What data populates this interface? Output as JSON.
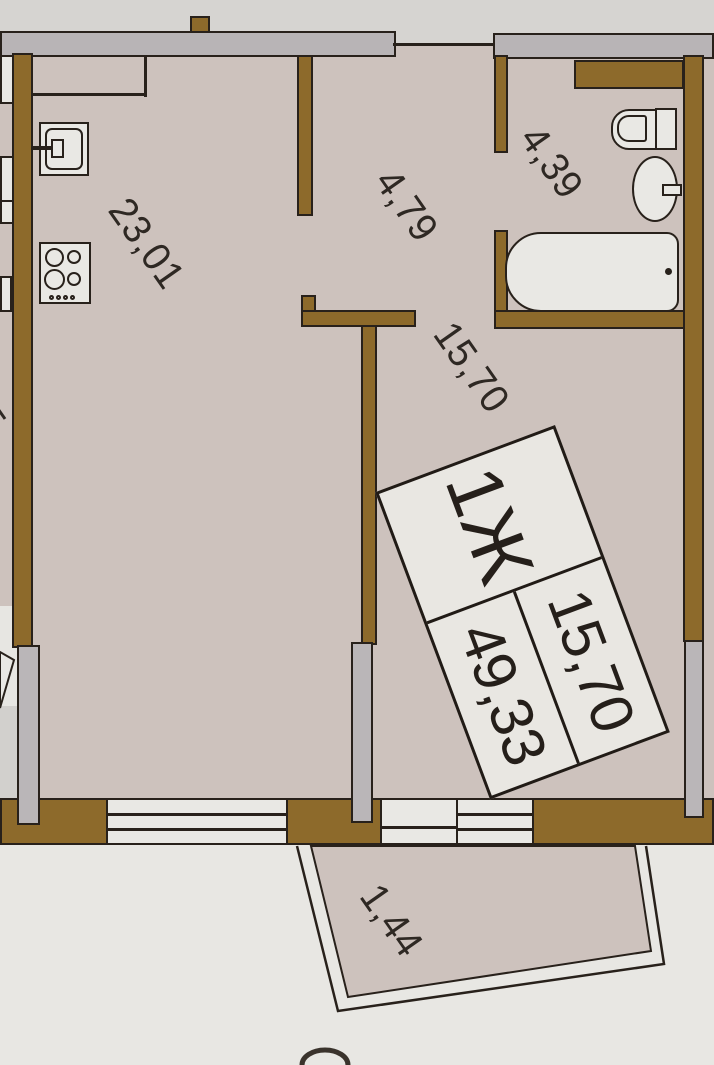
{
  "plan": {
    "title": "apartment-floor-plan",
    "unit_label": {
      "type": "1Ж",
      "living_area": "15,70",
      "total_area": "49,33"
    },
    "dimensions": {
      "kitchen_living": "23,01",
      "hallway": "4,79",
      "bathroom": "4,39",
      "room": "15,70",
      "balcony": "1,44",
      "edge_partial": "5"
    },
    "fixtures": [
      "kitchen-sink",
      "stove",
      "toilet",
      "wash-basin",
      "bathtub"
    ],
    "colors": {
      "wall_brown": "#8d6a2b",
      "floor_beige": "#cdc2bd",
      "panel_gray": "#b8b4b6",
      "outside_gray": "#d6d4d1",
      "paper_white": "#e8e7e3",
      "line_black": "#28211b",
      "fixture_fill": "#e9e8e4",
      "label_bg": "#e9e7e2",
      "text": "#2e2823"
    }
  }
}
